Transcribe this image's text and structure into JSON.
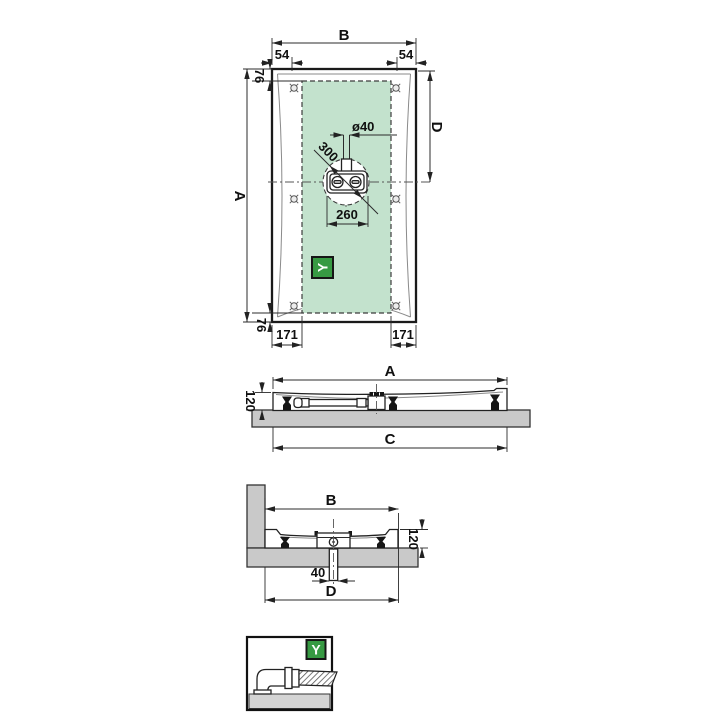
{
  "top_view": {
    "b": "B",
    "left_54": "54",
    "right_54": "54",
    "top_76": "76",
    "a": "A",
    "d": "D",
    "pipe_dia": "ø40",
    "circle_300": "300",
    "drain_260": "260",
    "bottom_76": "76",
    "left_171": "171",
    "right_171": "171",
    "icon": "Y"
  },
  "side_view": {
    "a": "A",
    "h120": "120",
    "c": "C"
  },
  "end_view": {
    "b": "B",
    "h120": "120",
    "pipe_40": "40",
    "d": "D"
  },
  "detail_view": {
    "icon": "Y"
  },
  "colors": {
    "zone_green": "#c3e2cd",
    "icon_green": "#379a43",
    "slab_gray": "#c9c9c9",
    "floor_gray": "#d4d4d4"
  }
}
